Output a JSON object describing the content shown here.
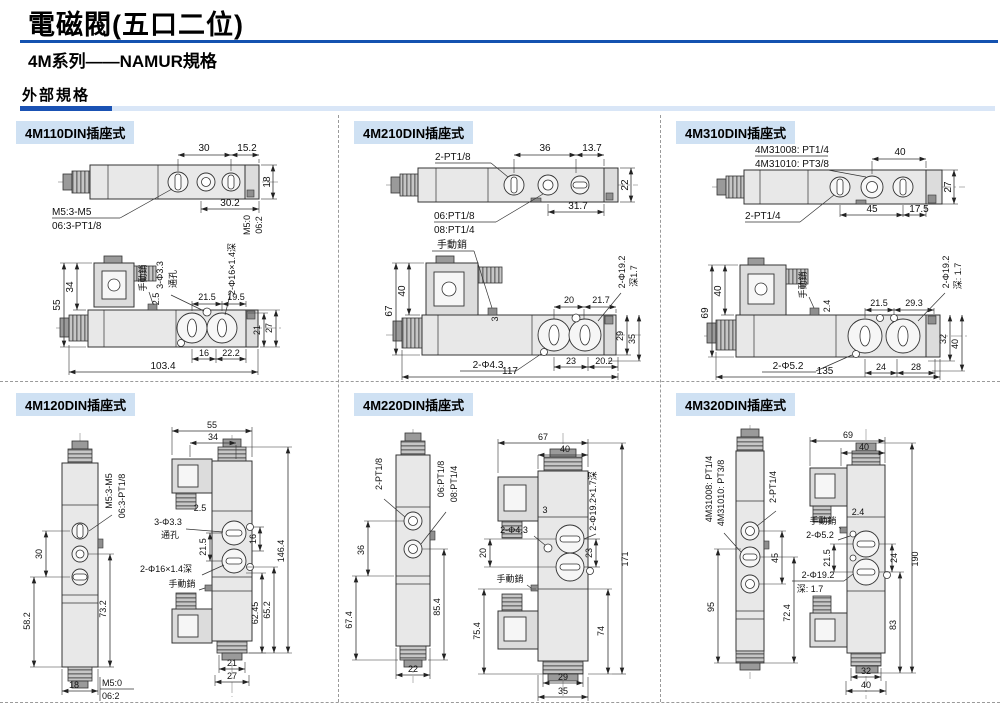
{
  "header": {
    "title": "電磁閥(五口二位)",
    "subtitle": "4M系列——NAMUR規格",
    "section": "外部規格"
  },
  "colors": {
    "accent_blue": "#1452b0",
    "dark_bar": "#1a52b4",
    "light_bar": "#d9e6f7",
    "panel_label_bg": "#cfe1f3"
  },
  "panels": [
    {
      "label": "4M110DIN插座式",
      "t": {
        "d30": "30",
        "d152": "15.2",
        "d18": "18",
        "lblM5": "M5:3-M5",
        "lblPT": "06:3-PT1/8",
        "d302": "30.2",
        "m50": "M5:0",
        "o62": "06:2",
        "d55": "55",
        "d34": "34",
        "manual": "手動銷",
        "holes": "3-Φ3.3",
        "thru": "通孔",
        "cbore": "2-Φ16×1.4深",
        "d215": "21.5",
        "d195": "19.5",
        "d25": "2.5",
        "d21": "21",
        "d27": "27",
        "d16": "16",
        "d222": "22.2",
        "total": "103.4"
      }
    },
    {
      "label": "4M210DIN插座式",
      "t": {
        "lbl2pt": "2-PT1/8",
        "d36": "36",
        "d137": "13.7",
        "d22": "22",
        "lbl06": "06:PT1/8",
        "lbl08": "08:PT1/4",
        "d317": "31.7",
        "manual": "手動銷",
        "d67": "67",
        "d40": "40",
        "d3": "3",
        "d20": "20",
        "d217": "21.7",
        "cbore": "2-Φ19.2",
        "depth": "深1.7",
        "d29": "29",
        "d35": "35",
        "holes": "2-Φ4.3",
        "d23": "23",
        "d202": "20.2",
        "total": "117"
      }
    },
    {
      "label": "4M310DIN插座式",
      "t": {
        "lbl08": "4M31008: PT1/4",
        "lbl10": "4M31010: PT3/8",
        "d40": "40",
        "d27": "27",
        "lbl2pt": "2-PT1/4",
        "d45": "45",
        "d175": "17.5",
        "manual": "手動銷",
        "d69": "69",
        "d40b": "40",
        "d24": "2.4",
        "d215": "21.5",
        "d293": "29.3",
        "cbore": "2-Φ19.2",
        "depth": "深: 1.7",
        "d32": "32",
        "d40c": "40",
        "holes": "2-Φ5.2",
        "dd24": "24",
        "d28": "28",
        "total": "135"
      }
    },
    {
      "label": "4M120DIN插座式",
      "t": {
        "lblM5": "M5:3-M5",
        "lblPT": "06:3-PT1/8",
        "d30": "30",
        "d582": "58.2",
        "d732": "73.2",
        "d18": "18",
        "m50": "M5:0",
        "o62": "06:2",
        "d55": "55",
        "d34": "34",
        "d25": "2.5",
        "holes": "3-Φ3.3",
        "thru": "通孔",
        "d215": "21.5",
        "d16": "16",
        "cbore": "2-Φ16×1.4深",
        "manual": "手動銷",
        "d6245": "62.45",
        "d652": "65.2",
        "total": "146.4",
        "d21": "21",
        "d27": "27"
      }
    },
    {
      "label": "4M220DIN插座式",
      "t": {
        "lbl2pt": "2-PT1/8",
        "lbl06": "06:PT1/8",
        "lbl08": "08:PT1/4",
        "d36": "36",
        "d674": "67.4",
        "d854": "85.4",
        "d22": "22",
        "d67": "67",
        "d40": "40",
        "cbore": "2-Φ19.2×1.7深",
        "d3": "3",
        "holes": "2-Φ4.3",
        "d20": "20",
        "manual": "手動銷",
        "d754": "75.4",
        "d23": "23",
        "d74": "74",
        "total": "171",
        "d29": "29",
        "d35": "35"
      }
    },
    {
      "label": "4M320DIN插座式",
      "t": {
        "lbl08": "4M31008: PT1/4",
        "lbl10": "4M31010: PT3/8",
        "lbl2pt": "2-PT1/4",
        "d45": "45",
        "d95": "95",
        "d724": "72.4",
        "d69": "69",
        "d40": "40",
        "d190": "190",
        "d24": "2.4",
        "manual": "手動銷",
        "holes": "2-Φ5.2",
        "d215": "21.5",
        "dd24": "24",
        "d83": "83",
        "cbore": "2-Φ19.2",
        "depth": "深: 1.7",
        "d32": "32",
        "d40b": "40"
      }
    }
  ]
}
